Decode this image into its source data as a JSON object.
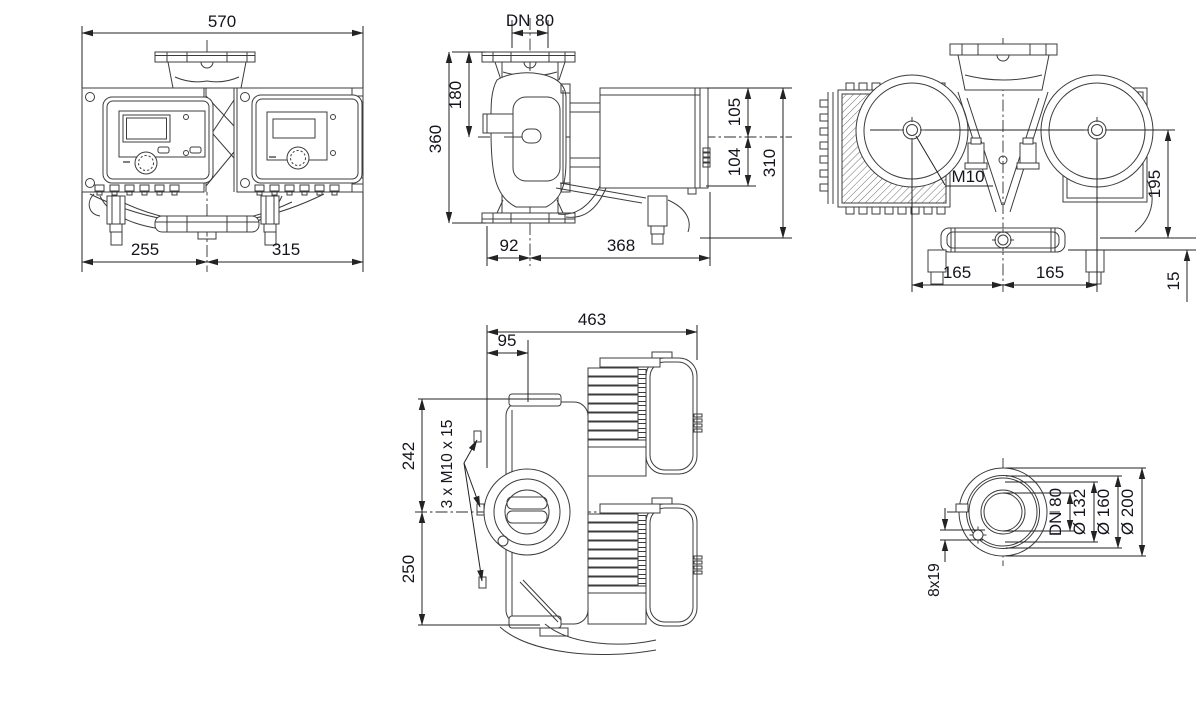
{
  "drawing": {
    "background": "#ffffff",
    "line_color": "#3c3c3c",
    "dim_color": "#232323",
    "text_color": "#14141c",
    "views": {
      "front": {
        "total_width": "570",
        "left_of_center": "255",
        "right_of_center": "315"
      },
      "side": {
        "nominal_bore": "DN 80",
        "flange_to_axis": "180",
        "port_to_port": "360",
        "axis_to_module_top": "105",
        "axis_to_module_bottom": "104",
        "module_height": "310",
        "axis_to_flange_face": "92",
        "axis_to_module_rear": "368"
      },
      "top": {
        "bolt_size": "M10",
        "bolt_to_rear": "195",
        "bolt_pitch_left": "165",
        "bolt_pitch_right": "165",
        "rear_offset": "15"
      },
      "rear": {
        "total_depth": "463",
        "flange_to_axis": "95",
        "axis_to_top": "242",
        "axis_to_bottom": "250",
        "bolt_note": "3 x M10 x 15"
      },
      "flange": {
        "nominal_bore": "DN 80",
        "bolt_circle_dia": "Ø 132",
        "raised_face_dia": "Ø 160",
        "outer_dia": "Ø 200",
        "bolt_holes": "8x19"
      }
    }
  }
}
